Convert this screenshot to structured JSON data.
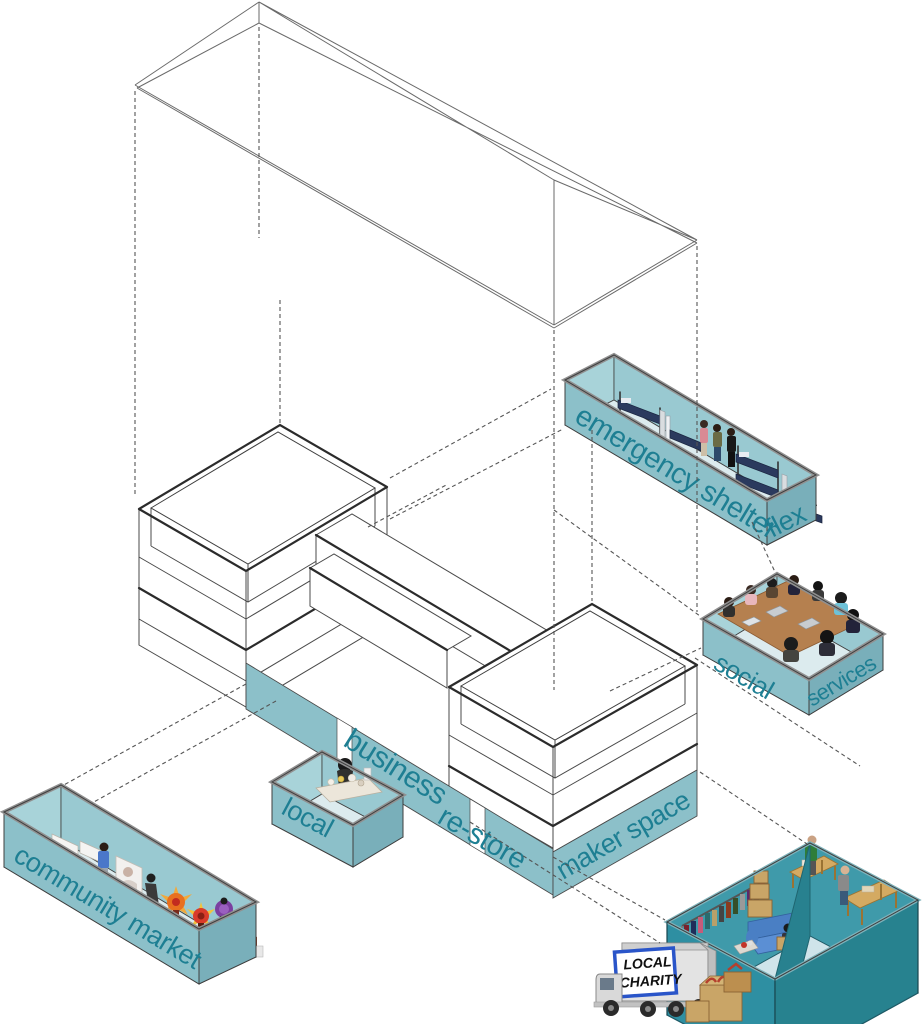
{
  "colors": {
    "wall": "#8cc0c9",
    "wall_dark": "#79afba",
    "wall_inner": "#a8d3d9",
    "wall_inner2": "#99c9d1",
    "floor": "#dcebee",
    "deep_wall": "#2e8fa2",
    "deep_wall_dark": "#27828f",
    "deep_inner": "#3f9aaa",
    "deep_floor": "#cfe4ea",
    "label_text": "#1e7f93",
    "line": "#4a4a4a",
    "line_heavy": "#2b2b2b",
    "edge_strip": "#909090",
    "navy": "#2b3a5e",
    "wood": "#b5804f",
    "bench_wood": "#d4aa62",
    "couch": "#5b8fd4",
    "carton": "#c9a567",
    "sign_blue": "#2a55c9"
  },
  "labels": {
    "emergency_shelter": "emergency shelter",
    "emergency_flex": "flex",
    "social": "social",
    "services": "services",
    "business": "business",
    "local": "local",
    "restore": "re-store",
    "maker_space": "maker space",
    "community_market": "community market"
  },
  "truck": {
    "line1": "LOCAL",
    "line2": "CHARITY"
  }
}
